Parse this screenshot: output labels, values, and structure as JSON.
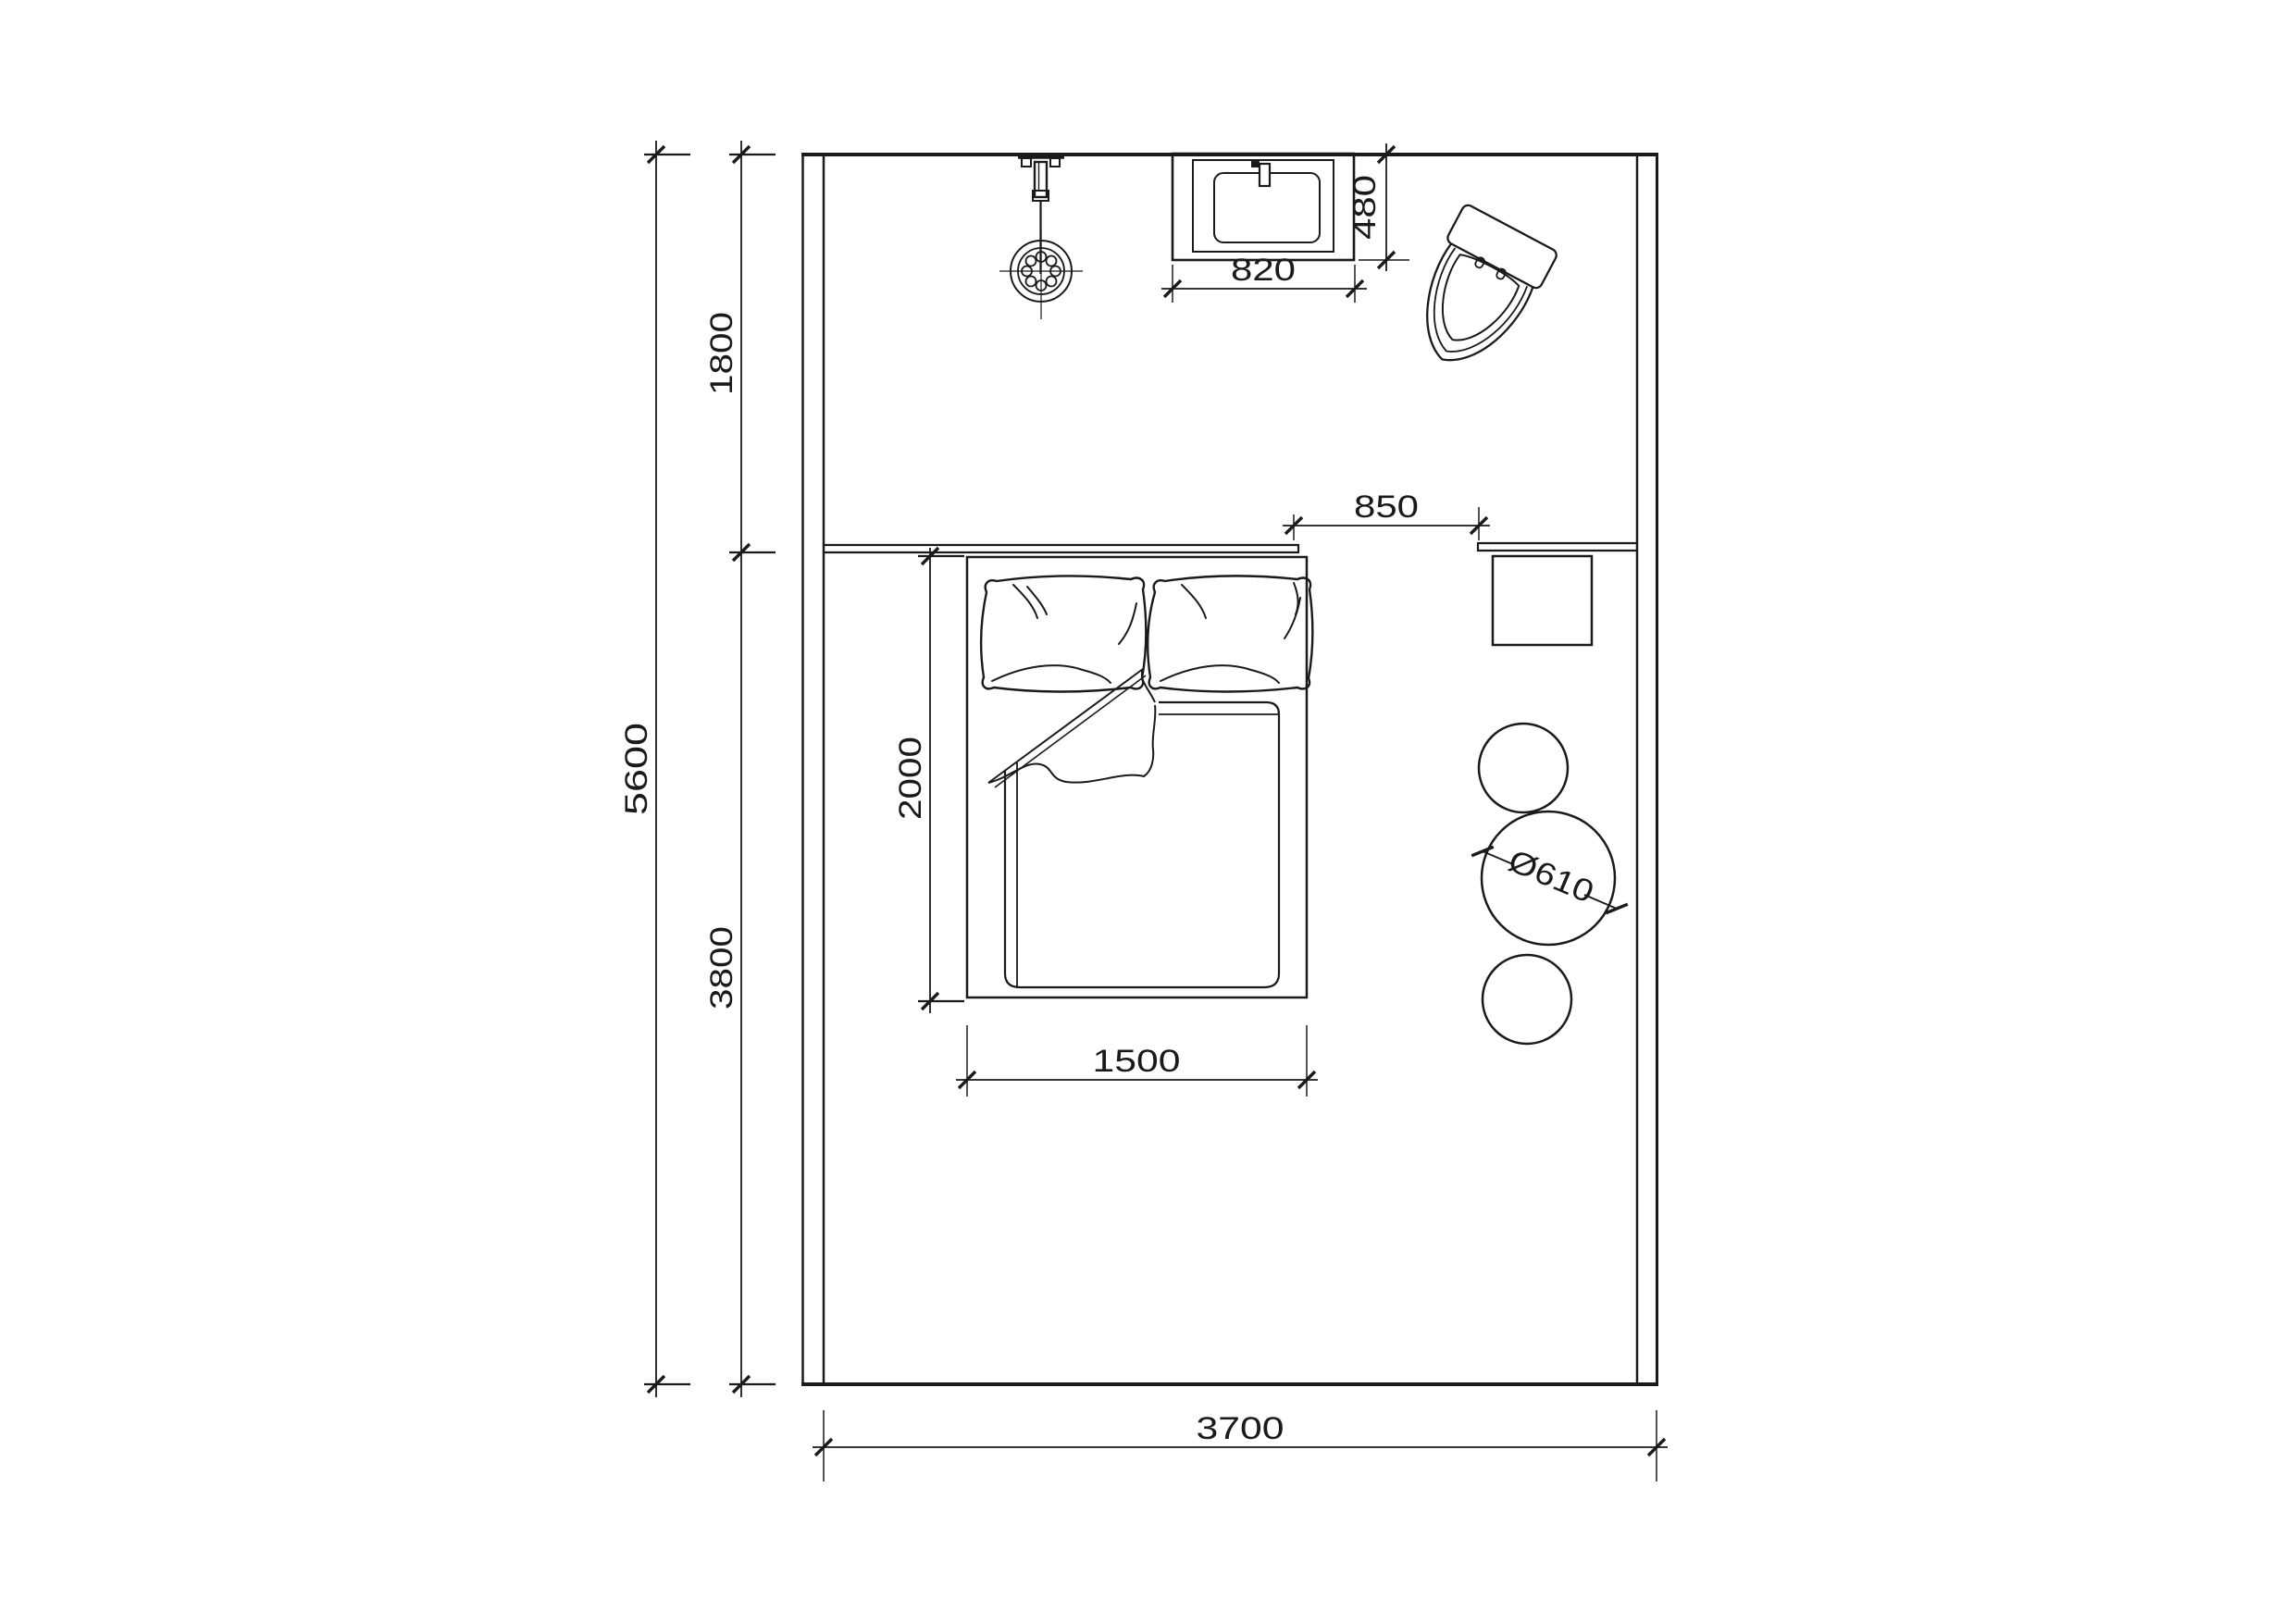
{
  "drawing": {
    "kind": "bedroom-bathroom floor plan",
    "background_color": "#ffffff",
    "line_color": "#1a1a1a"
  },
  "dimensions": {
    "room_depth_total": "5600",
    "bath_zone_depth": "1800",
    "bed_zone_depth": "3800",
    "room_width": "3700",
    "bed_length": "2000",
    "bed_width": "1500",
    "bed_to_desk_gap": "850",
    "sink_width": "820",
    "sink_depth": "480",
    "table_diameter": "Ø610"
  }
}
